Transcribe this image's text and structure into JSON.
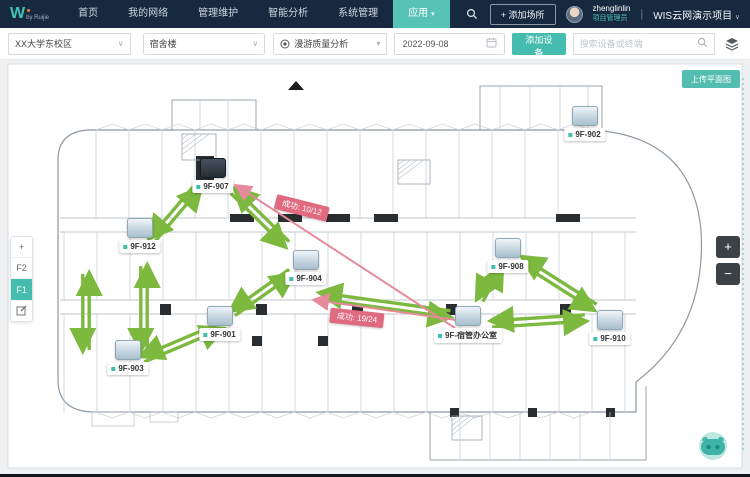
{
  "topnav": {
    "logo_brand": "W",
    "logo_sub": "by Ruijie",
    "items": [
      {
        "label": "首页",
        "active": false
      },
      {
        "label": "我的网络",
        "active": false
      },
      {
        "label": "管理维护",
        "active": false
      },
      {
        "label": "智能分析",
        "active": false
      },
      {
        "label": "系统管理",
        "active": false
      },
      {
        "label": "应用",
        "active": true,
        "caret": true
      }
    ],
    "add_place_button": "+ 添加场所",
    "user": {
      "name": "zhenglinlin",
      "role": "项目管理员"
    },
    "project": "WIS云网演示项目"
  },
  "toolbar": {
    "site_select": "XX大学东校区",
    "building_select": "宿舍楼",
    "analysis_select": "漫游质量分析",
    "date": "2022-09-08",
    "add_device_button": "添加设备",
    "search_placeholder": "搜索设备或终端"
  },
  "map": {
    "upload_button": "上传平面图",
    "floor_add": "+",
    "floors": [
      {
        "label": "F2",
        "active": false
      },
      {
        "label": "F1",
        "active": true
      }
    ],
    "zoom_in": "+",
    "zoom_out": "−",
    "aps": [
      {
        "name": "9F-907",
        "x": 213,
        "y": 108,
        "dark": true
      },
      {
        "name": "9F-912",
        "x": 140,
        "y": 168
      },
      {
        "name": "9F-904",
        "x": 306,
        "y": 200
      },
      {
        "name": "9F-901",
        "x": 220,
        "y": 256
      },
      {
        "name": "9F-903",
        "x": 128,
        "y": 290
      },
      {
        "name": "9F-902",
        "x": 585,
        "y": 56
      },
      {
        "name": "9F-908",
        "x": 508,
        "y": 188
      },
      {
        "name": "9F-宿管办公室",
        "x": 468,
        "y": 256
      },
      {
        "name": "9F-910",
        "x": 610,
        "y": 260
      }
    ],
    "roam_links_success": [
      {
        "from": "9F-912",
        "to": "9F-907",
        "x1": 152,
        "y1": 180,
        "x2": 198,
        "y2": 126
      },
      {
        "from": "9F-907",
        "to": "9F-904",
        "x1": 233,
        "y1": 131,
        "x2": 287,
        "y2": 184
      },
      {
        "from": "9F-903",
        "to": "9F-912",
        "x1": 86,
        "y1": 290,
        "x2": 86,
        "y2": 214
      },
      {
        "from": "9F-903",
        "to": "9F-912",
        "x1": 144,
        "y1": 290,
        "x2": 144,
        "y2": 206
      },
      {
        "from": "9F-903",
        "to": "9F-901",
        "x1": 143,
        "y1": 299,
        "x2": 221,
        "y2": 266
      },
      {
        "from": "9F-901",
        "to": "9F-904",
        "x1": 233,
        "y1": 253,
        "x2": 291,
        "y2": 212
      },
      {
        "from": "9F-904",
        "to": "9F-宿管办公室",
        "x1": 320,
        "y1": 236,
        "x2": 450,
        "y2": 254
      },
      {
        "from": "9F-908",
        "to": "9F-宿管办公室",
        "x1": 499,
        "y1": 206,
        "x2": 480,
        "y2": 240
      },
      {
        "from": "9F-908",
        "to": "9F-910",
        "x1": 521,
        "y1": 200,
        "x2": 595,
        "y2": 247
      },
      {
        "from": "9F-910",
        "to": "9F-宿管办公室",
        "x1": 492,
        "y1": 264,
        "x2": 585,
        "y2": 258
      }
    ],
    "roam_links_fail": [
      {
        "from": "9F-宿管办公室",
        "to": "9F-907",
        "x1": 455,
        "y1": 268,
        "x2": 237,
        "y2": 126
      },
      {
        "from": "9F-宿管办公室",
        "to": "9F-904",
        "x1": 470,
        "y1": 262,
        "x2": 315,
        "y2": 240
      }
    ],
    "fail_labels": [
      {
        "text": "成功: 10/12",
        "x": 302,
        "y": 148,
        "rot": 14
      },
      {
        "text": "成功: 19/24",
        "x": 357,
        "y": 258,
        "rot": 6
      }
    ]
  },
  "colors": {
    "navy": "#16293e",
    "teal": "#45bcae",
    "green_link": "#7cb93e",
    "pink_link": "#e78a9b",
    "pink_label_bg": "#e06a80"
  }
}
